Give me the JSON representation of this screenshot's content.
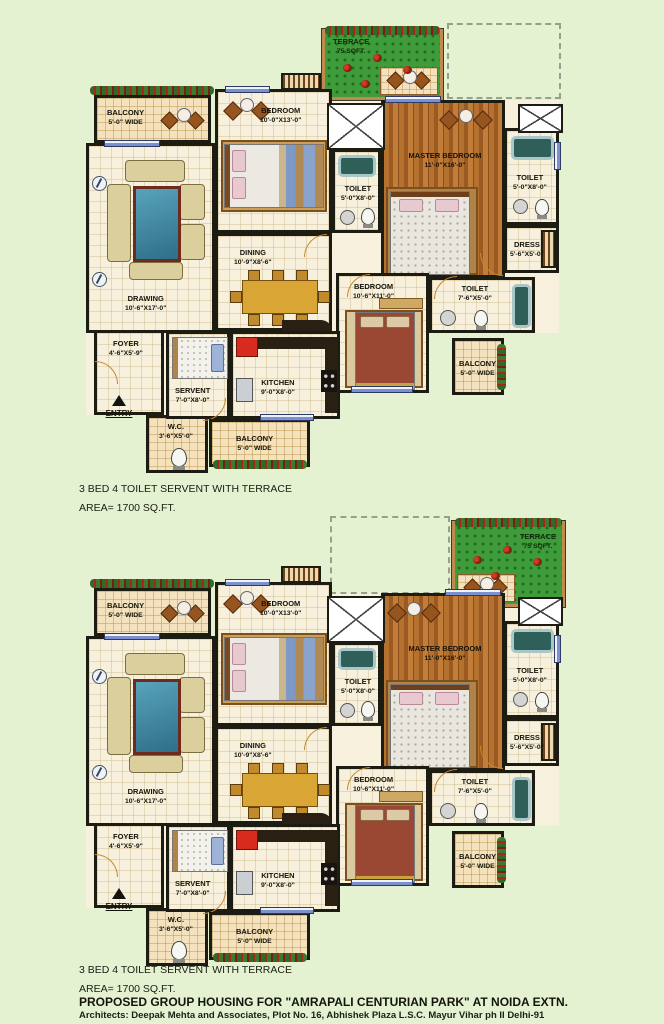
{
  "page": {
    "background": "#e4f2d2"
  },
  "plans": {
    "caption_line1": "3 BED 4 TOILET  SERVENT WITH TERRACE",
    "caption_line2": "AREA= 1700 SQ.FT."
  },
  "footer": {
    "title": "PROPOSED GROUP HOUSING FOR \"AMRAPALI CENTURIAN PARK\" AT NOIDA EXTN.",
    "architects": "Architects: Deepak Mehta and Associates, Plot No. 16, Abhishek Plaza L.S.C. Mayur Vihar ph II Delhi-91"
  },
  "rooms": {
    "terrace": {
      "name": "TERRACE",
      "dim": "75 SQFT."
    },
    "balcony_tl": {
      "name": "BALCONY",
      "dim": "5'-0\" WIDE"
    },
    "bedroom_top": {
      "name": "BEDROOM",
      "dim": "10'-0\"X13'-0\""
    },
    "toilet_mid": {
      "name": "TOILET",
      "dim": "5'-0\"X8'-0\""
    },
    "master_bedroom": {
      "name": "MASTER BEDROOM",
      "dim": "11'-0\"X16'-0\""
    },
    "toilet_top_right": {
      "name": "TOILET",
      "dim": "5'-0\"X8'-0\""
    },
    "dress": {
      "name": "DRESS",
      "dim": "5'-6\"X5'-0\""
    },
    "toilet_right": {
      "name": "TOILET",
      "dim": "7'-6\"X5'-0\""
    },
    "bedroom_right": {
      "name": "BEDROOM",
      "dim": "10'-6\"X11'-0\""
    },
    "balcony_right": {
      "name": "BALCONY",
      "dim": "5'-0\" WIDE"
    },
    "drawing": {
      "name": "DRAWING",
      "dim": "10'-6\"X17'-0\""
    },
    "dining": {
      "name": "DINING",
      "dim": "10'-9\"X8'-6\""
    },
    "foyer": {
      "name": "FOYER",
      "dim": "4'-6\"X5'-9\""
    },
    "servent": {
      "name": "SERVENT",
      "dim": "7'-0\"X8'-0\""
    },
    "kitchen": {
      "name": "KITCHEN",
      "dim": "9'-0\"X8'-0\""
    },
    "wc": {
      "name": "W.C.",
      "dim": "3'-6\"X5'-0\""
    },
    "balcony_bottom": {
      "name": "BALCONY",
      "dim": "5'-0\" WIDE"
    },
    "entry": {
      "label": "ENTRY"
    }
  },
  "colors": {
    "wall": "#1c1c12",
    "terrace_green": "#3f9c3b",
    "floor_cream": "#f7f0dd",
    "balcony_tan": "#f3e2bd",
    "wood_brown": "#a96a2c",
    "window_blue": "#7b90cc",
    "flower_red": "#b02218"
  }
}
